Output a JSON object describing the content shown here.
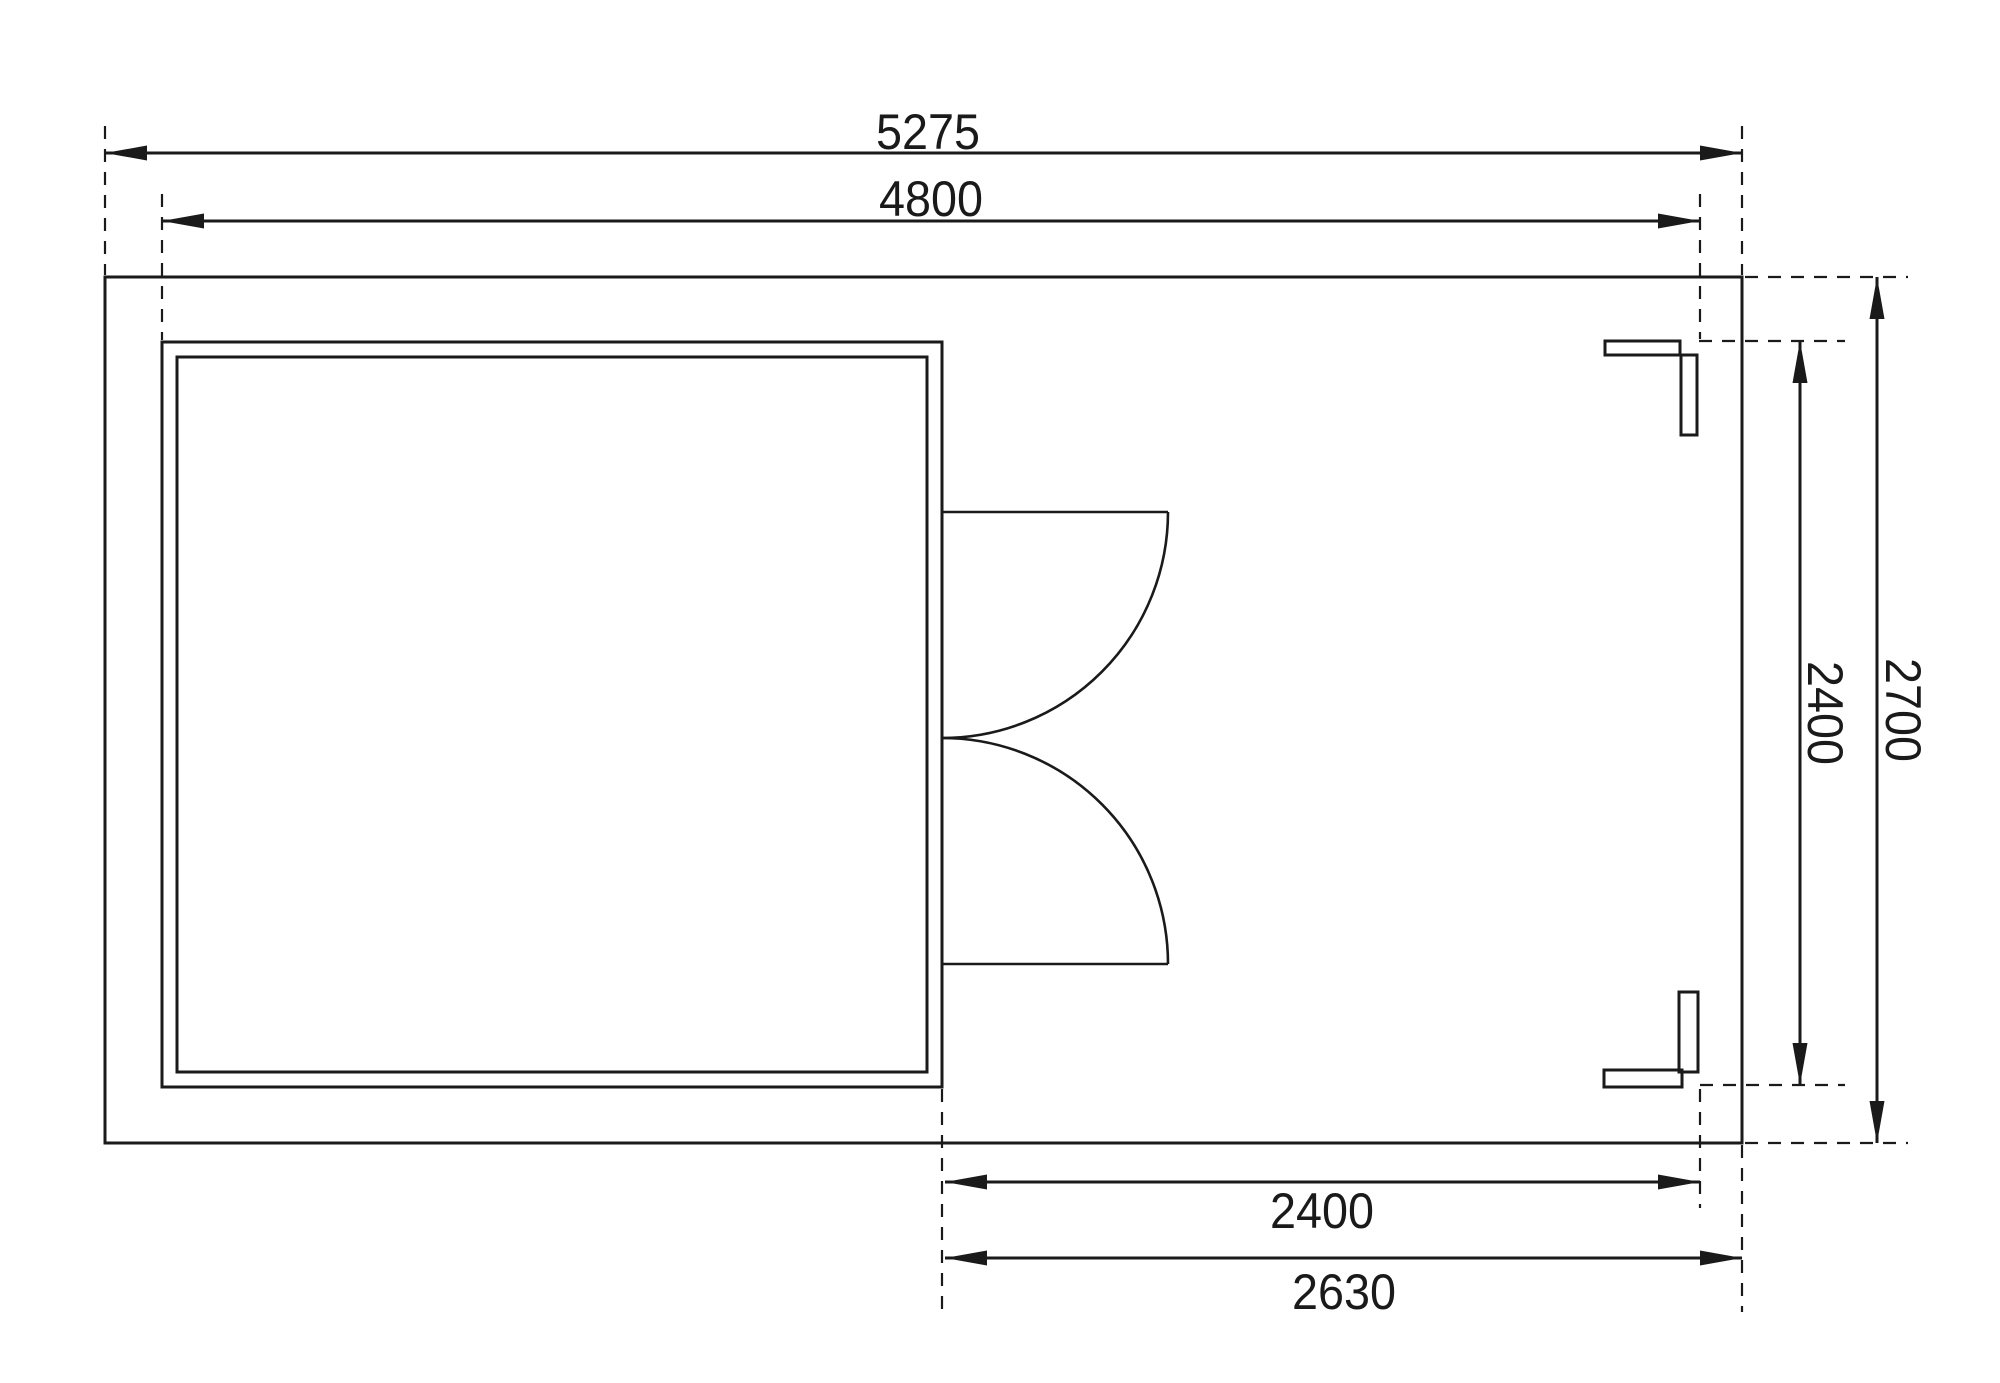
{
  "drawing": {
    "kind": "floor-plan-technical-drawing",
    "dimensions": {
      "overall_width": "5275",
      "building_width": "4800",
      "side_depth_inner": "2400",
      "side_depth_overall": "2700",
      "front_opening_width": "2400",
      "front_annex_width": "2630"
    }
  },
  "colors": {
    "line": "#1a1a1a",
    "boundary_fill": "#ffffff",
    "wall_fill": "#a9a9a9",
    "interior_fill": "#f6f6f6",
    "post_fill": "#bfbfbf"
  }
}
